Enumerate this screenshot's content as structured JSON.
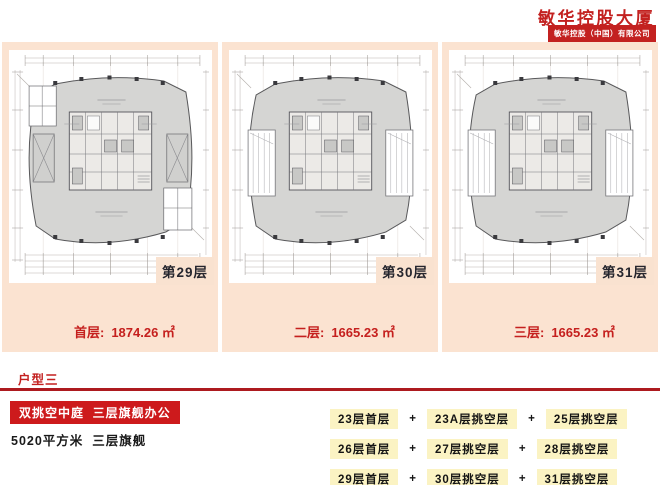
{
  "header": {
    "title": "敏华控股大厦",
    "subtitle": "敏华控股（中国）有限公司"
  },
  "panels": [
    {
      "floor_label": "第29层",
      "area_label": "首层:",
      "area_value": "1874.26 ㎡",
      "plan": "full"
    },
    {
      "floor_label": "第30层",
      "area_label": "二层:",
      "area_value": "1665.23 ㎡",
      "plan": "void"
    },
    {
      "floor_label": "第31层",
      "area_label": "三层:",
      "area_value": "1665.23 ㎡",
      "plan": "void"
    }
  ],
  "section": {
    "title": "户型三",
    "highlight": "双挑空中庭  三层旗舰办公",
    "subtitle": "5020平方米  三层旗舰",
    "plus": "+",
    "table": {
      "rows": [
        [
          "23层首层",
          "23A层挑空层",
          "25层挑空层"
        ],
        [
          "26层首层",
          "27层挑空层",
          "28层挑空层"
        ],
        [
          "29层首层",
          "30层挑空层",
          "31层挑空层"
        ]
      ]
    }
  },
  "colors": {
    "brand_red": "#c32120",
    "rule_red": "#ad1a1f",
    "panel_salmon": "#fbe3d1",
    "cell_yellow": "#fbf3c3",
    "plan_grey": "#d5d5d3",
    "floor_tag_text": "#26262e"
  }
}
